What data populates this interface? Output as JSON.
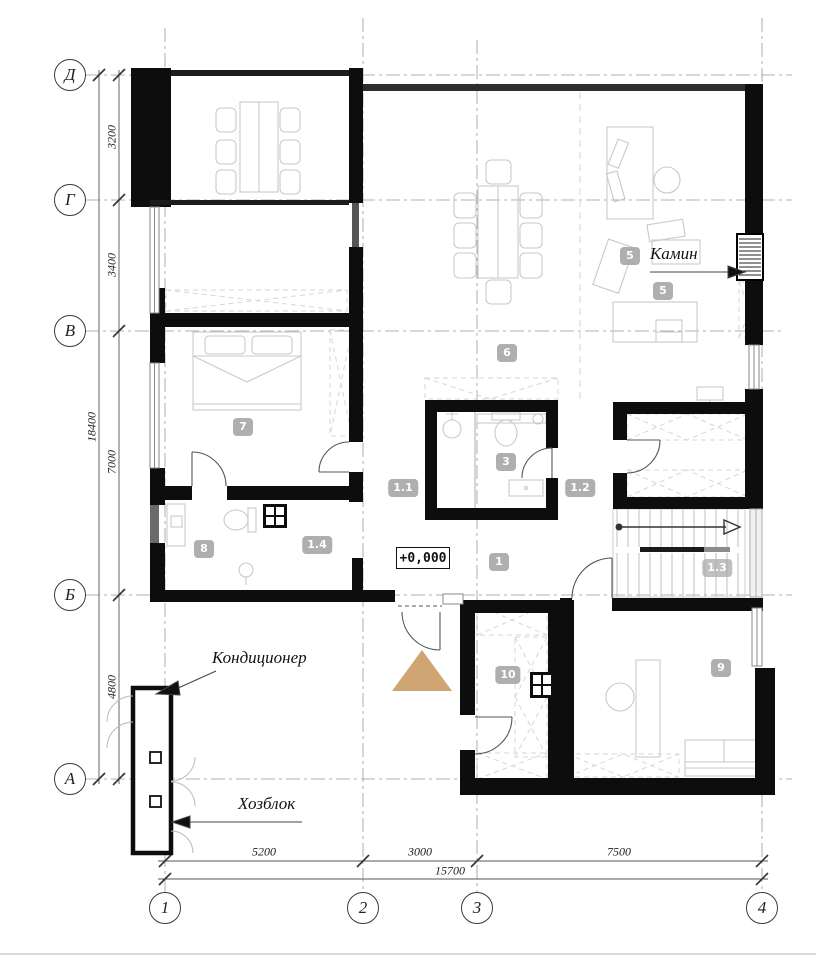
{
  "axes": {
    "rows": [
      {
        "label": "Д",
        "y": 75
      },
      {
        "label": "Г",
        "y": 200
      },
      {
        "label": "В",
        "y": 331
      },
      {
        "label": "Б",
        "y": 595
      },
      {
        "label": "А",
        "y": 779
      }
    ],
    "cols": [
      {
        "label": "1",
        "x": 165
      },
      {
        "label": "2",
        "x": 363
      },
      {
        "label": "3",
        "x": 477
      },
      {
        "label": "4",
        "x": 762
      }
    ]
  },
  "dimensions": {
    "left_segments": [
      {
        "value": "3200",
        "y": 137
      },
      {
        "value": "3400",
        "y": 265
      },
      {
        "value": "7000",
        "y": 462
      },
      {
        "value": "4800",
        "y": 687
      }
    ],
    "left_total": {
      "value": "18400",
      "y": 427
    },
    "bottom_segments": [
      {
        "value": "5200",
        "x": 264
      },
      {
        "value": "3000",
        "x": 420
      },
      {
        "value": "7500",
        "x": 619
      }
    ],
    "bottom_total": {
      "value": "15700",
      "x": 450
    }
  },
  "room_badges": [
    {
      "label": "5",
      "x": 630,
      "y": 256
    },
    {
      "label": "5",
      "x": 663,
      "y": 291
    },
    {
      "label": "6",
      "x": 507,
      "y": 353
    },
    {
      "label": "7",
      "x": 243,
      "y": 427
    },
    {
      "label": "8",
      "x": 204,
      "y": 549
    },
    {
      "label": "3",
      "x": 506,
      "y": 462
    },
    {
      "label": "1.1",
      "x": 403,
      "y": 488
    },
    {
      "label": "1.2",
      "x": 580,
      "y": 488
    },
    {
      "label": "1",
      "x": 499,
      "y": 562
    },
    {
      "label": "1.3",
      "x": 717,
      "y": 568
    },
    {
      "label": "1.4",
      "x": 317,
      "y": 545
    },
    {
      "label": "10",
      "x": 508,
      "y": 675
    },
    {
      "label": "9",
      "x": 721,
      "y": 668
    }
  ],
  "annotations": {
    "fireplace": "Камин",
    "air_conditioner": "Кондиционер",
    "utility_block": "Хозблок",
    "level_mark": "+0,000"
  },
  "colors": {
    "wall": "#0d0d0d",
    "badge": "#a9a9a9",
    "entry_arrow": "#d0a574",
    "furniture": "#c9c9c9",
    "grid": "#999999"
  }
}
